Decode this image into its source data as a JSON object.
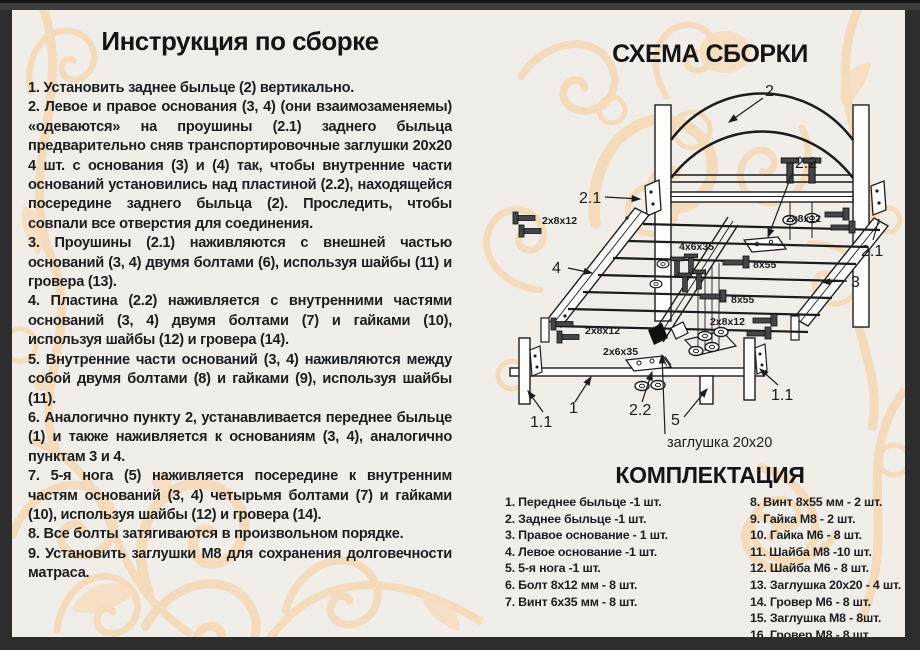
{
  "instructions": {
    "title": "Инструкция по сборке",
    "steps": [
      "1. Установить заднее быльце (2) вертикально.",
      "2. Левое и правое основания (3, 4) (они взаимозаменяемы) «одеваются» на проушины (2.1) заднего быльца предварительно сняв транспортировочные заглушки 20х20 4 шт. с основания (3) и (4) так, чтобы внутренние части оснований установились над пластиной (2.2), находящейся посередине заднего быльца (2). Проследить, чтобы совпали все отверстия для соединения.",
      "3. Проушины (2.1) наживляются с внешней частью оснований (3, 4) двумя болтами (6), используя шайбы (11) и гровера (13).",
      "4. Пластина (2.2) наживляется с внутренними частями оснований (3, 4) двумя болтами (7) и гайками (10), используя шайбы (12) и гровера (14).",
      "5. Внутренние части оснований (3, 4) наживляются между собой двумя болтами (8) и гайками (9), используя шайбы (11).",
      "6. Аналогично пункту 2, устанавливается переднее быльце (1) и также наживляется к основаниям (3, 4), аналогично пунктам 3 и 4.",
      "7. 5-я нога (5) наживляется посередине к внутренним частям оснований (3, 4) четырьмя болтами (7) и гайками (10), используя шайбы (12) и гровера (14).",
      "8. Все болты затягиваются в произвольном порядке.",
      "9. Установить заглушки М8 для сохранения долговечности матраса."
    ]
  },
  "schema": {
    "title": "СХЕМА СБОРКИ",
    "cap_note": "заглушка 20x20",
    "part_labels": {
      "headboard": "2",
      "lug_left": "2.1",
      "lug_right": "2.1",
      "plate_top": "2.2",
      "plate_front": "2.2",
      "base_right": "3",
      "base_left": "4",
      "fifth_leg": "5",
      "front_rail": "1",
      "front_leg_left": "1.1",
      "front_leg_right": "1.1"
    },
    "hardware_labels": {
      "bolts_a": "2x8x12",
      "bolts_b": "2x8x12",
      "bolts_c": "2x8x12",
      "bolts_d": "2x8x12",
      "screws_center": "4x6x35",
      "screw_long_a": "8x55",
      "screw_long_b": "8x55",
      "screws_front": "2x6x35"
    }
  },
  "parts": {
    "title": "КОМПЛЕКТАЦИЯ",
    "left_column": [
      "1. Переднее быльце -1 шт.",
      "2. Заднее быльце -1 шт.",
      "3. Правое основание - 1 шт.",
      "4. Левое основание -1 шт.",
      "5. 5-я нога -1 шт.",
      "6. Болт 8х12 мм - 8 шт.",
      "7. Винт 6х35 мм - 8 шт."
    ],
    "right_column": [
      "8. Винт 8х55 мм - 2 шт.",
      "9. Гайка М8 - 2 шт.",
      "10. Гайка М6 - 8 шт.",
      "11. Шайба М8 -10 шт.",
      "12. Шайба М6 - 8 шт.",
      "13. Заглушка 20х20 - 4 шт.",
      "14. Гровер М6 - 8 шт.",
      "15. Заглушка М8 - 8шт.",
      "16. Гровер М8 - 8 шт."
    ]
  },
  "colors": {
    "page_bg": "#f1eeea",
    "frame": "#2d2d2d",
    "text": "#1c1c1c",
    "ornament_stroke": "#f4d8b6",
    "ornament_fill": "#f6ddc0"
  }
}
